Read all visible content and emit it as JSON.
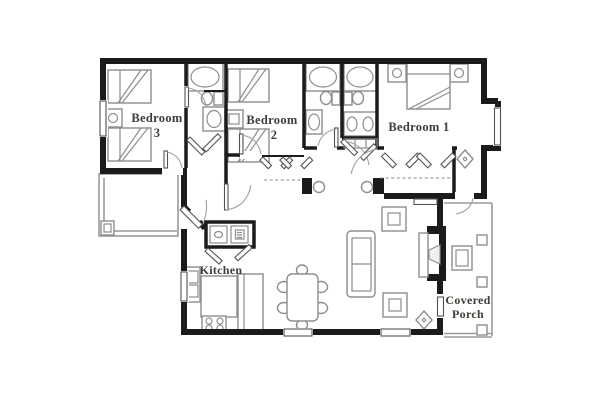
{
  "floor_plan": {
    "type": "residential floor plan, 3 bedroom unit",
    "rooms": {
      "bedroom_3": {
        "name_line1": "Bedroom",
        "name_line2": "3"
      },
      "bedroom_2": {
        "name_line1": "Bedroom",
        "name_line2": "2"
      },
      "bedroom_1": {
        "name": "Bedroom 1"
      },
      "kitchen": {
        "name": "Kitchen"
      },
      "covered_porch": {
        "name_line1": "Covered",
        "name_line2": "Porch"
      }
    },
    "colors": {
      "background": "#ffffff",
      "wall": "#1b1b19",
      "fixture_line": "#8d8d8b",
      "label_text": "#3f3d37"
    },
    "fixtures": [
      "double-bed",
      "nightstand",
      "bathtub",
      "toilet",
      "sink-vanity",
      "double-sink-vanity",
      "washer-dryer-closet",
      "bifold-closet-doors",
      "kitchen-island",
      "range-4-burner",
      "counter-refrigerator",
      "dining-table-6-chairs",
      "sofa",
      "end-table-lamp",
      "fireplace",
      "ceiling-fixture-diamond",
      "porch-posts",
      "porch-chair",
      "front-entry-door",
      "windows",
      "hall-columns",
      "left-deck"
    ]
  }
}
